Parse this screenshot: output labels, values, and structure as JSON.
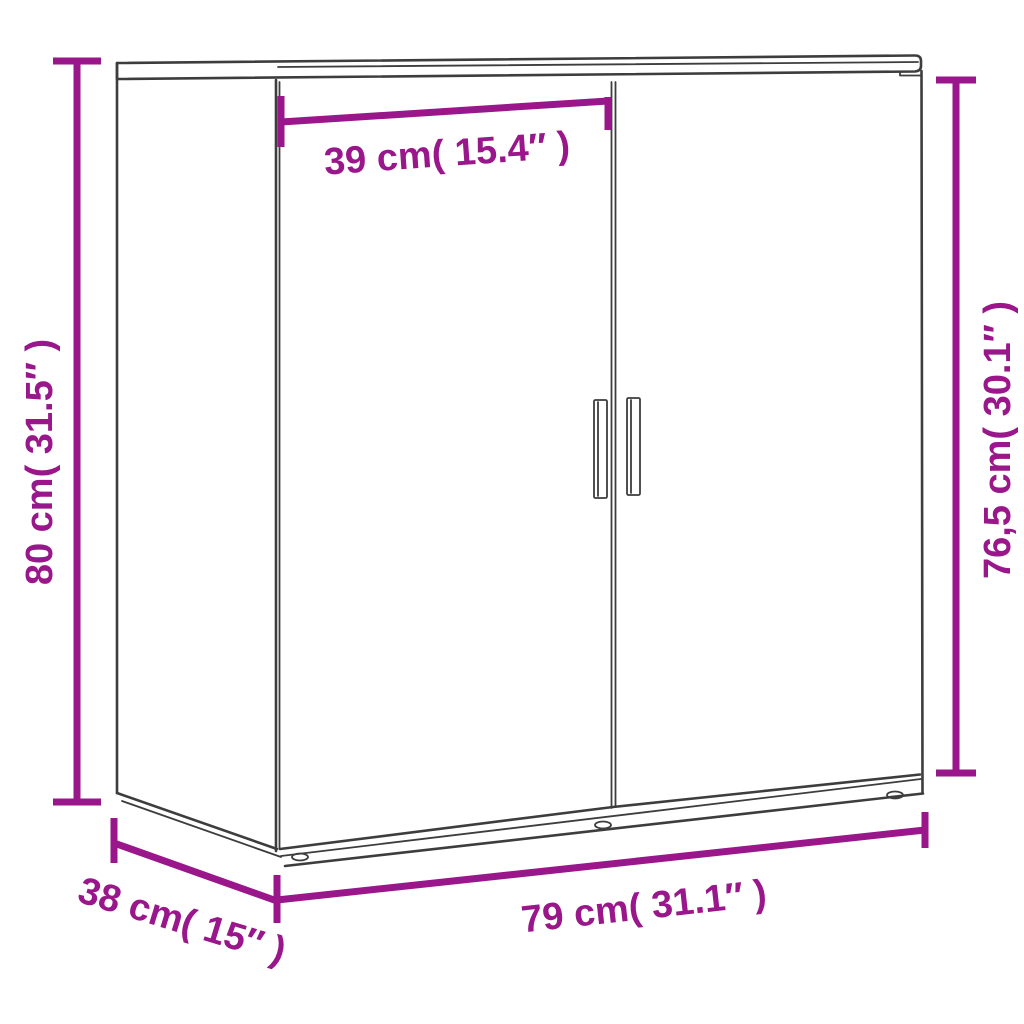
{
  "diagram": {
    "colors": {
      "dimension_accent": "#99168b",
      "cabinet_outline": "#3d3d3d",
      "background": "#ffffff"
    },
    "labels": {
      "height": "80 cm( 31.5″ )",
      "door_width": "39 cm( 15.4″ )",
      "side_height": "76,5 cm( 30.1″ )",
      "width": "79 cm( 31.1″ )",
      "depth": "38 cm( 15″ )"
    }
  }
}
